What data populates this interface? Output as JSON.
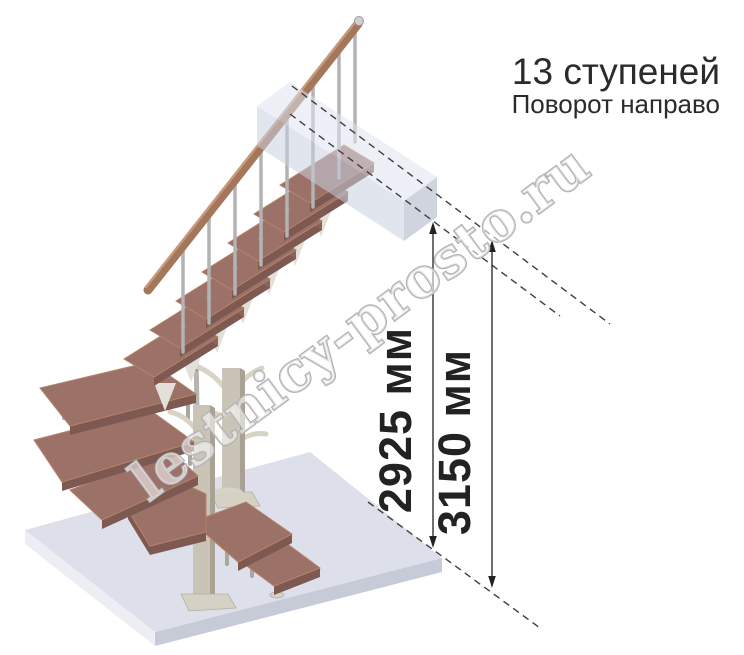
{
  "header": {
    "title": "13 ступеней",
    "subtitle": "Поворот направо"
  },
  "dimensions": {
    "dim1": "2925 мм",
    "dim2": "3150 мм"
  },
  "watermark": {
    "text": "lestnicy-prosto.ru"
  },
  "scene": {
    "straight_treads": 7,
    "winder_treads": 6,
    "icons": [
      "up-arrow-icon",
      "down-arrow-icon"
    ]
  },
  "colors": {
    "tread_top": "#9b7168",
    "tread_edge": "#b58468",
    "tread_front": "#7d5952",
    "tread_end": "#8a635b",
    "rail": "#a4765a",
    "rail_light": "#c79a7d",
    "baluster": "#b3b3b3",
    "post": "#cac4b6",
    "post_shade": "#a9a294",
    "post_base": "#d6d1c5",
    "branch": "#d8d3c7",
    "pole": "#b5b5ad",
    "rod": "#a8a8a0",
    "joint": "#8f8f87",
    "bracket": "#e3e0d9",
    "floor_top": "#dde0ea",
    "floor_left": "#eceef4",
    "floor_right": "#c7cbd8",
    "box_top": "#dfe4f0",
    "box_front": "#c9d0e0",
    "box_right": "#aab2c6",
    "dash": "#3f3f3f",
    "dim": "#222222",
    "text": "#2b2b2b",
    "watermark_stroke": "#b0b0b0"
  }
}
